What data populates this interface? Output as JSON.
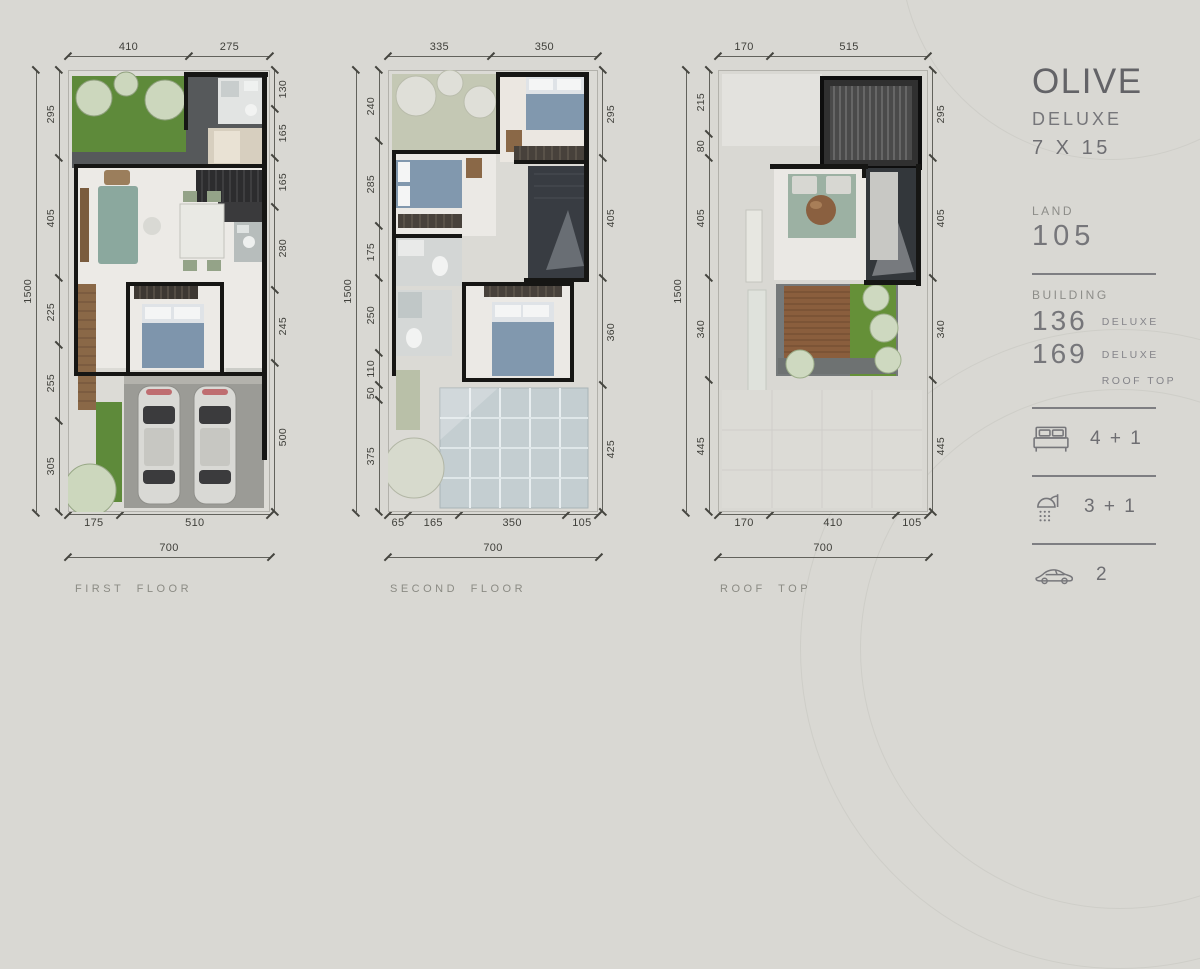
{
  "plans": [
    {
      "id": "first-floor",
      "label": "FIRST FLOOR",
      "overall_height": "1500",
      "overall_width": "700",
      "dims_top": [
        "410",
        "275"
      ],
      "dims_left": [
        "295",
        "405",
        "225",
        "255",
        "305"
      ],
      "dims_right": [
        "130",
        "165",
        "165",
        "280",
        "245",
        "500"
      ],
      "dims_bottom": [
        "175",
        "510"
      ]
    },
    {
      "id": "second-floor",
      "label": "SECOND FLOOR",
      "overall_height": "1500",
      "overall_width": "700",
      "dims_top": [
        "335",
        "350"
      ],
      "dims_left": [
        "240",
        "285",
        "175",
        "250",
        "110",
        "50",
        "375"
      ],
      "dims_right": [
        "295",
        "405",
        "360",
        "425"
      ],
      "dims_bottom": [
        "65",
        "165",
        "350",
        "105"
      ]
    },
    {
      "id": "roof-top",
      "label": "ROOF TOP",
      "overall_height": "1500",
      "overall_width": "700",
      "dims_top": [
        "170",
        "515"
      ],
      "dims_left": [
        "215",
        "80",
        "405",
        "340",
        "445"
      ],
      "dims_right": [
        "295",
        "405",
        "340",
        "445"
      ],
      "dims_bottom": [
        "170",
        "410",
        "105"
      ]
    }
  ],
  "info_panel": {
    "title": "OLIVE",
    "subtitle": "DELUXE",
    "size": "7 X 15",
    "land_label": "LAND",
    "land_value": "105",
    "building_label": "BUILDING",
    "building_items": [
      {
        "value": "136",
        "note": "DELUXE",
        "note2": ""
      },
      {
        "value": "169",
        "note": "DELUXE",
        "note2": "ROOF TOP"
      }
    ],
    "features": [
      {
        "name": "bedrooms",
        "icon": "bed-icon",
        "value": "4 + 1"
      },
      {
        "name": "bathrooms",
        "icon": "shower-icon",
        "value": "3 + 1"
      },
      {
        "name": "carport",
        "icon": "car-icon",
        "value": "2"
      }
    ],
    "colors": {
      "background": "#d9d8d3",
      "text": "#6e6e72",
      "dimension_text": "#3f3f3a"
    }
  }
}
